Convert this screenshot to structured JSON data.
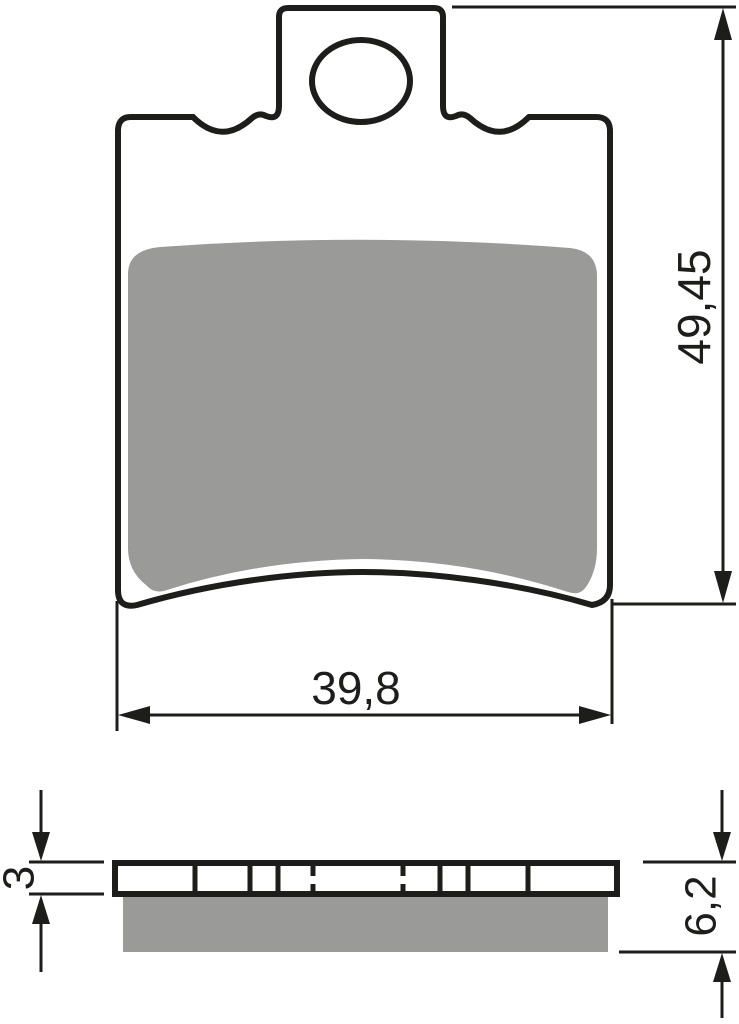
{
  "colors": {
    "line": "#1d1d1b",
    "friction": "#9a9a99",
    "background": "#ffffff"
  },
  "front_view": {
    "height_dimension": "49,45",
    "width_dimension": "39,8"
  },
  "side_view": {
    "plate_thickness_dimension": "3",
    "total_thickness_dimension": "6,2"
  }
}
